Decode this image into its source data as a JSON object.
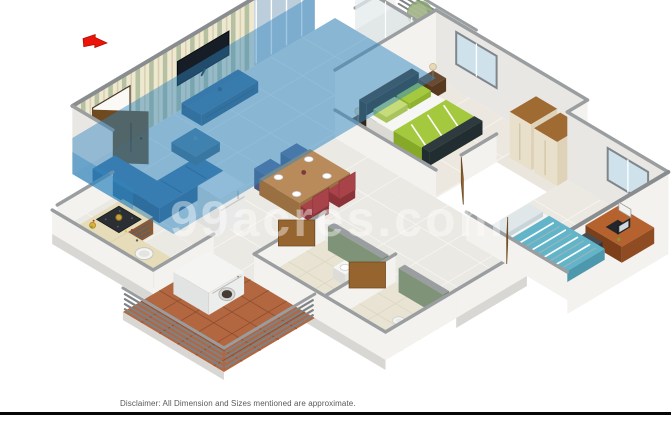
{
  "watermark": {
    "text": "99acres.com"
  },
  "disclaimer": {
    "text": "Disclaimer: All Dimension and Sizes mentioned are approximate."
  },
  "icons": {
    "entry_direction": "red-arrow-icon"
  },
  "palette": {
    "wall": "#f3f2ef",
    "wallDim": "#e9e7e3",
    "cap": "#9b9ea0",
    "capDark": "#8a8d8f",
    "paperBg": "#efe8d1",
    "stripe1": "#b5c1a1",
    "stripe2": "#d8cfae",
    "tile": "#ebe9e3",
    "tileDim": "#e2dfd8",
    "tileLine": "#f8f7f4",
    "overlay": "#2f85bf",
    "glass": "#bccedb",
    "glassLite": "#e6edf0",
    "glassFrame": "#80878c",
    "terra": "#b26740",
    "terraLine": "#8f4e2e",
    "greenWall": "#7e9377",
    "wood": "#96652f",
    "woodDark": "#6f4a20",
    "sofa": "#3e74a3",
    "tv": "#161d26",
    "tvUnit": "#40709a",
    "tvUnitDark": "#355d81",
    "counter": "#e7dcba",
    "counterDim": "#d9cda6",
    "cabinet": "#8a5a34",
    "cabinetDark": "#6f4526",
    "steel": "#5a6066",
    "hob": "#2b2f33",
    "pan": "#c8a23c",
    "white": "#f6f6f4",
    "offWhite": "#e6e5e1",
    "headboard": "#463527",
    "bedGreen": "#a5c93e",
    "bedGreenLt": "#c6dc78",
    "throw": "#2e3a3f",
    "cream": "#e9e0cb",
    "creamDim": "#ded3b8",
    "wardTop": "#a06a33",
    "teal": "#62b4c9",
    "tealLt": "#dfe7e9",
    "desk": "#b5622f",
    "deskDark": "#8f4c22",
    "maroon": "#a8434a",
    "chairBlue": "#5d6b96",
    "tableWood": "#b98a5a",
    "tableWoodDark": "#9a6f42",
    "plant": "#8aa371",
    "plantLt": "#aebd93",
    "pot": "#cbc7bd",
    "arrow": "#ec1408",
    "dark": "#474c52",
    "slab": "#d8d7d4",
    "rail": "#7e8285"
  }
}
